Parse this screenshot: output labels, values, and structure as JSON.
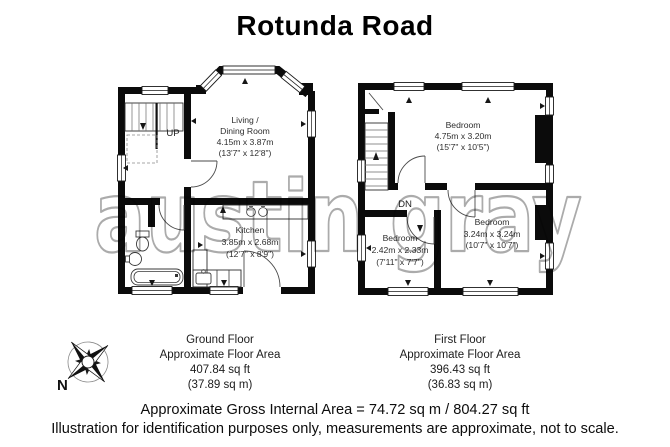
{
  "title": "Rotunda Road",
  "watermark": "austin gray",
  "ground_floor": {
    "stairs_label": "UP",
    "living_room": {
      "line1": "Living /",
      "line2": "Dining Room",
      "metric": "4.15m x 3.87m",
      "imperial": "(13'7\" x 12'8\")"
    },
    "kitchen": {
      "name": "Kitchen",
      "metric": "3.85m x 2.68m",
      "imperial": "(12'7\" x 8'9\")"
    },
    "caption": {
      "name": "Ground Floor",
      "area_label": "Approximate Floor Area",
      "area_ft": "407.84 sq ft",
      "area_m": "(37.89 sq m)"
    }
  },
  "first_floor": {
    "stairs_label": "DN",
    "bedroom_main": {
      "name": "Bedroom",
      "metric": "4.75m x 3.20m",
      "imperial": "(15'7\" x 10'5\")"
    },
    "bedroom_second": {
      "name": "Bedroom",
      "metric": "3.24m x 3.24m",
      "imperial": "(10'7\" x 10'7\")"
    },
    "bedroom_small": {
      "name": "Bedroom",
      "metric": "2.42m x 2.33m",
      "imperial": "(7'11\" x 7'7\")"
    },
    "caption": {
      "name": "First Floor",
      "area_label": "Approximate Floor Area",
      "area_ft": "396.43 sq ft",
      "area_m": "(36.83 sq m)"
    }
  },
  "compass": {
    "north_label": "N"
  },
  "footer": {
    "gross_area": "Approximate Gross Internal Area = 74.72 sq m / 804.27 sq ft",
    "disclaimer": "Illustration for identification purposes only, measurements are approximate, not to scale."
  },
  "colors": {
    "wall": "#0b0b0b",
    "watermark": "#ababab",
    "text": "#1c1c1c",
    "background": "#ffffff"
  },
  "icons": [
    "compass-rose-icon",
    "bathtub",
    "toilet",
    "wash-basin",
    "kitchen-sink",
    "hob",
    "stairs",
    "door-arc",
    "window"
  ]
}
